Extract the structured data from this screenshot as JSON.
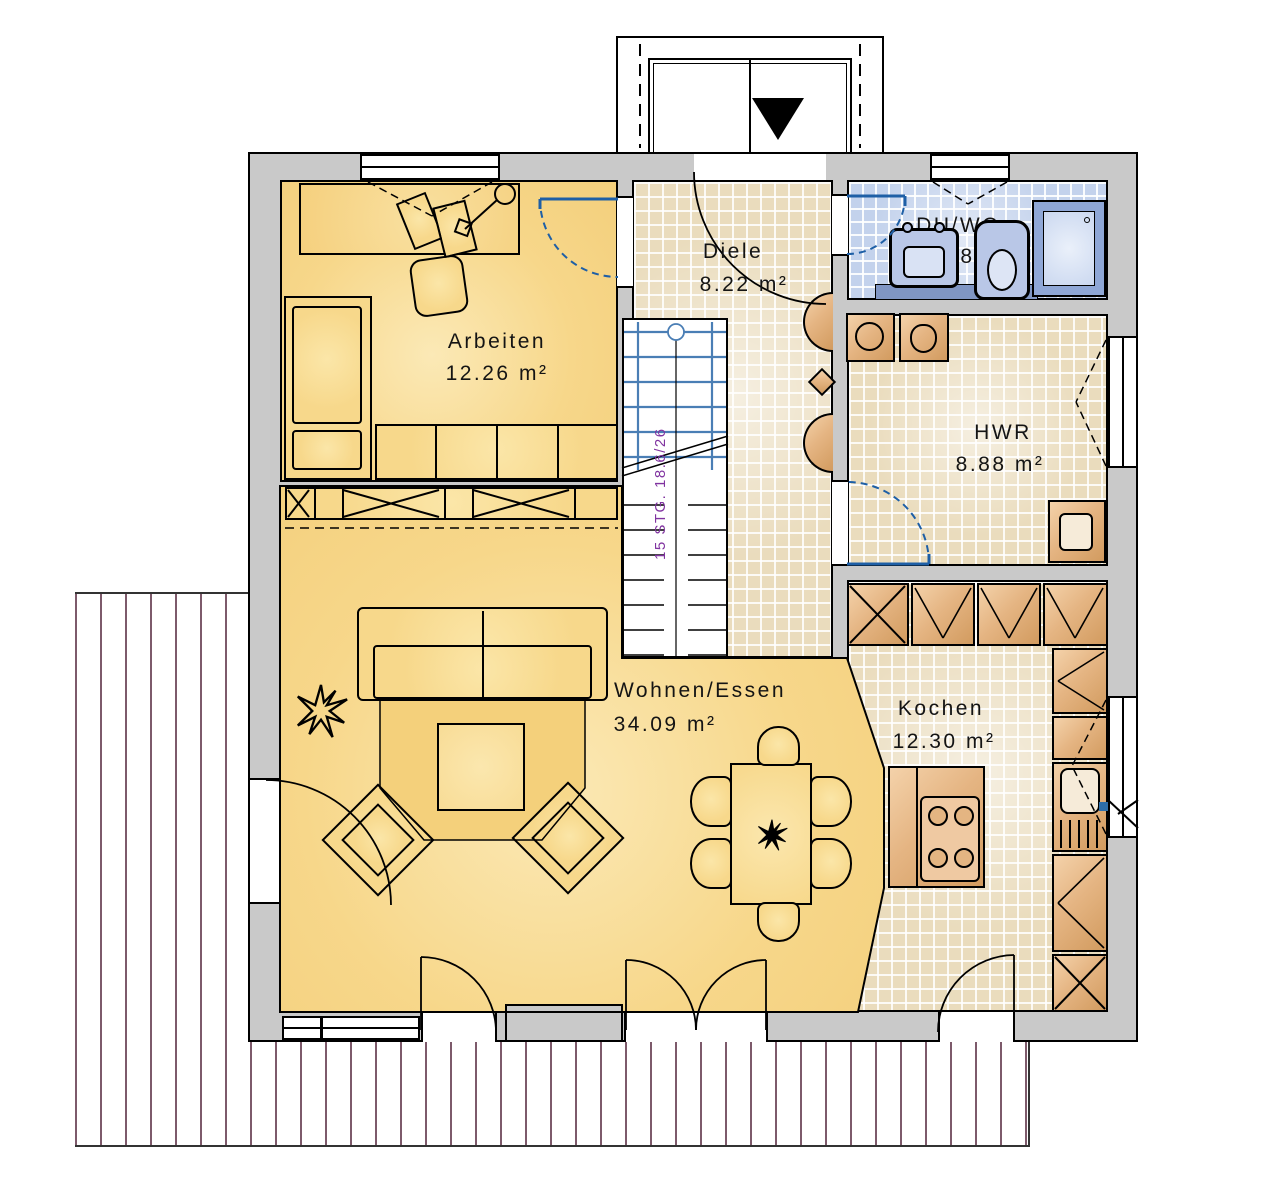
{
  "rooms": [
    {
      "id": "arbeiten",
      "name": "Arbeiten",
      "area": "12.26 m²"
    },
    {
      "id": "diele",
      "name": "Diele",
      "area": "8.22 m²"
    },
    {
      "id": "duwc",
      "name": "DU/WC",
      "area": "3.78 m²"
    },
    {
      "id": "hwr",
      "name": "HWR",
      "area": "8.88 m²"
    },
    {
      "id": "wohnen",
      "name": "Wohnen/Essen",
      "area": "34.09 m²"
    },
    {
      "id": "kochen",
      "name": "Kochen",
      "area": "12.30 m²"
    }
  ],
  "stairs": {
    "label": "15 STG. 18.6/26"
  },
  "palette": {
    "wall": "#C9C9C9",
    "floor_yellow": "#F7D78A",
    "tile_beige": "#EADCBD",
    "tile_blue": "#C3D2EC",
    "cabinet_tan": "#E5B583",
    "door_blue": "#1E5FA6",
    "stair_text_purple": "#8033A0",
    "terrace_stripe": "#7D5A6B"
  }
}
